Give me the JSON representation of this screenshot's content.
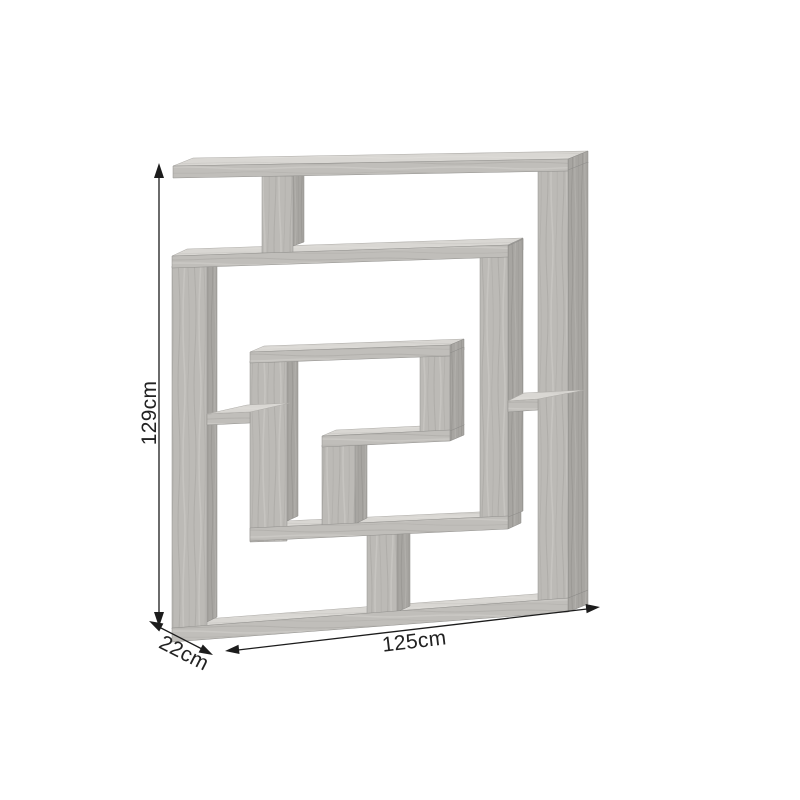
{
  "page": {
    "description": "Product dimension diagram of a maze-style geometric bookshelf on a white background",
    "background": "#ffffff"
  },
  "product": {
    "name": "maze-bookshelf",
    "material_colors": {
      "wood_front": "#bcbab6",
      "wood_top": "#d9d7d3",
      "wood_side": "#a7a5a1",
      "grain_dark": "#aeaca8",
      "grain_light": "#c6c4c0"
    }
  },
  "dimensions": {
    "height": {
      "label": "129cm",
      "axis": "vertical"
    },
    "width": {
      "label": "125cm",
      "axis": "horizontal"
    },
    "depth": {
      "label": "22cm",
      "axis": "diagonal"
    }
  },
  "annotation_style": {
    "arrow_color": "#1c1c1c",
    "label_color": "#222222"
  }
}
